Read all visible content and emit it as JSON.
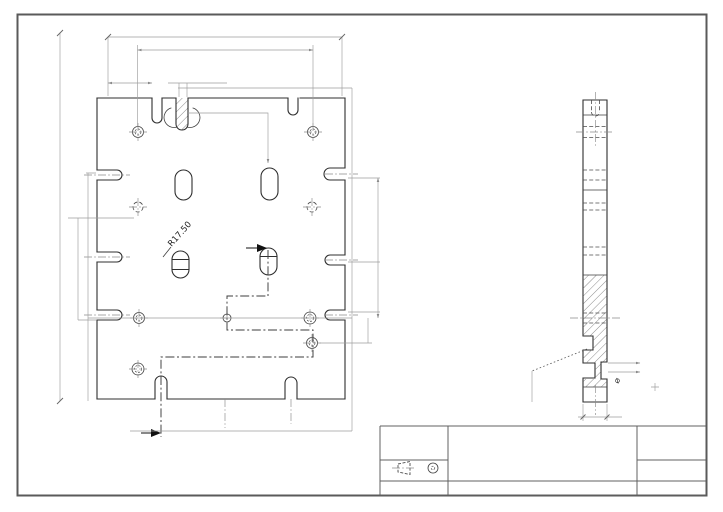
{
  "sheet": {
    "background": "#ffffff",
    "border_color": "#5a5a5a"
  },
  "line_colors": {
    "object": "#2f2f2f",
    "hidden": "#4c4c4c",
    "center": "#8a8a8a",
    "dimension": "#9d9d9d",
    "section": "#3d3d3d",
    "section_arrow": "#111111"
  },
  "front_view": {
    "radius_label": "R17.50"
  },
  "side_view": {
    "diameter_label": "⌀"
  },
  "title_block": {
    "projection_symbol": "third-angle"
  }
}
